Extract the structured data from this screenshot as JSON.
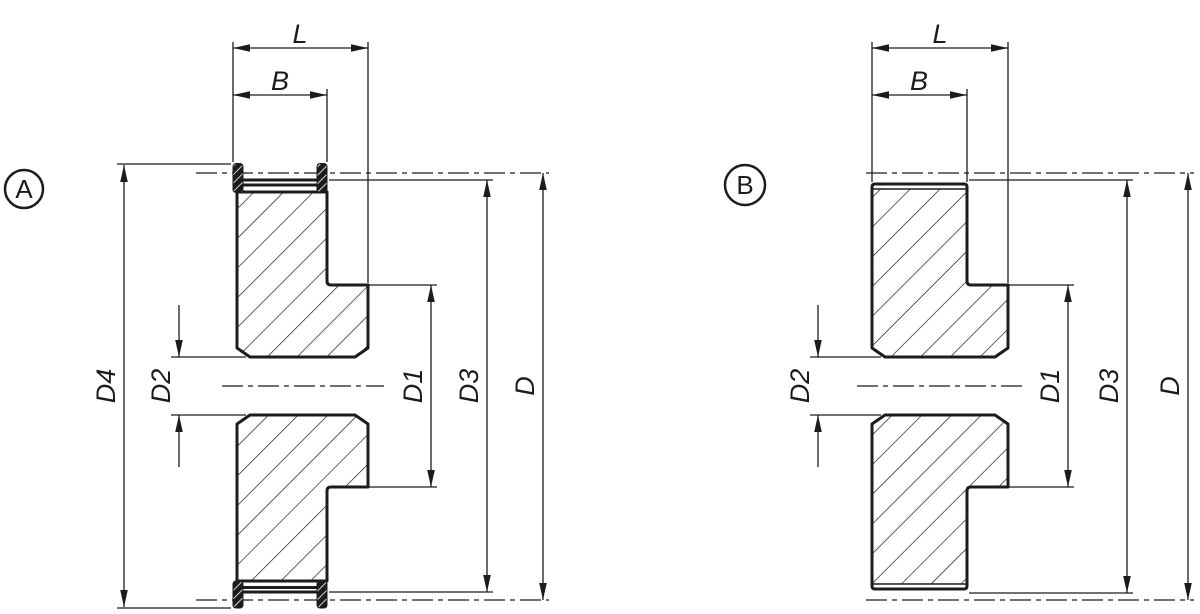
{
  "colors": {
    "line": "#1c1c1c",
    "background": "#ffffff"
  },
  "views": {
    "a": {
      "balloon": "A",
      "labels": {
        "l": "L",
        "b": "B",
        "d4": "D4",
        "d2": "D2",
        "d1": "D1",
        "d3": "D3",
        "d": "D"
      }
    },
    "b": {
      "balloon": "B",
      "labels": {
        "l": "L",
        "b": "B",
        "d2": "D2",
        "d1": "D1",
        "d3": "D3",
        "d": "D"
      }
    }
  }
}
